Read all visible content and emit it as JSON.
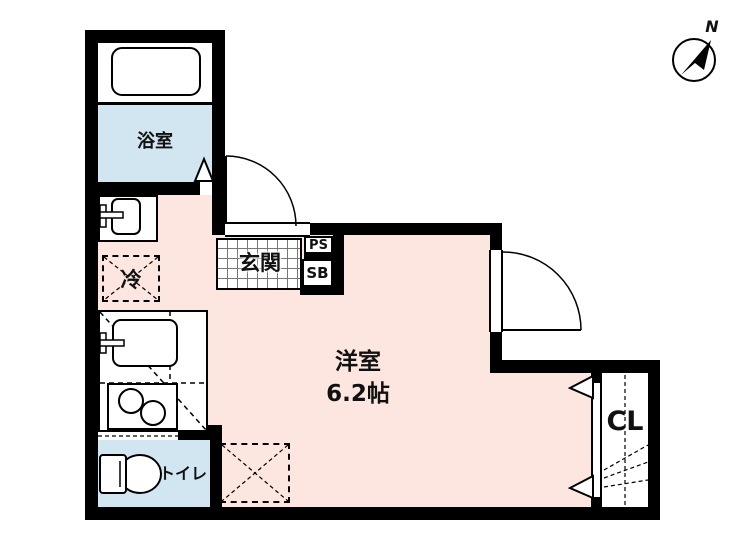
{
  "type": "floor-plan",
  "labels": {
    "bath": "浴室",
    "entrance": "玄関",
    "pipe_space": "PS",
    "shoe_box": "SB",
    "refrigerator": "冷",
    "room_name": "洋室",
    "room_size": "6.2帖",
    "toilet": "トイレ",
    "closet": "CL",
    "compass_north": "N"
  },
  "colors": {
    "wall": "#000000",
    "room_fill": "#fce6df",
    "wet_area_fill": "#d2e6f2",
    "tile_line": "#777777"
  }
}
